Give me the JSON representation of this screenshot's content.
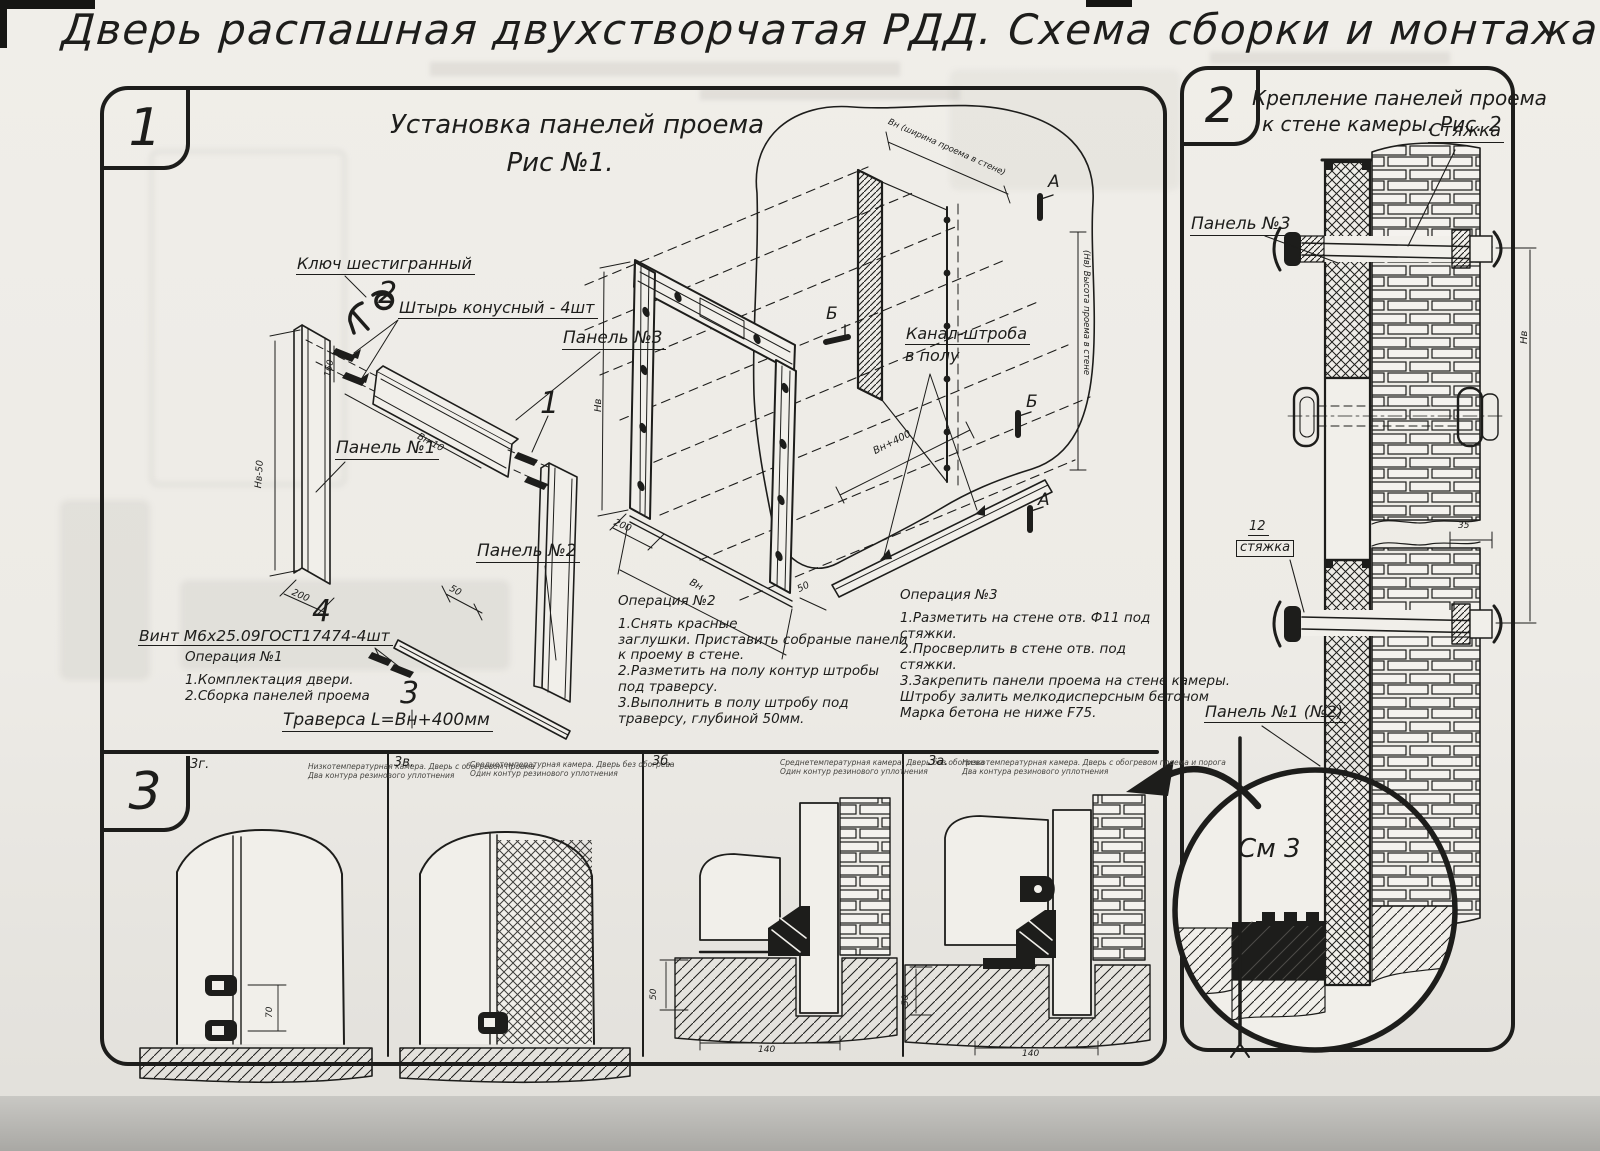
{
  "title": "Дверь распашная двухстворчатая РДД.  Схема сборки и монтажа №2",
  "s1": {
    "badge": "1",
    "fig_title": "Установка панелей проема",
    "fig_sub": "Рис №1.",
    "labels": {
      "hex_key": "Ключ шестигранный",
      "pin": "Штырь конусный - 4шт",
      "panel3": "Панель №3",
      "panel1": "Панель №1",
      "panel2": "Панель №2",
      "screw": "Винт М6х25.09ГОСТ17474-4шт",
      "traverse": "Траверса  L=Вн+400мм",
      "channel1": "Канал-штроба",
      "channel2": "в полу"
    },
    "callouts": {
      "c1": "1",
      "c2": "2",
      "c3": "3",
      "c4": "4"
    },
    "markers": {
      "a": "А",
      "b": "Б"
    },
    "dims": {
      "nv50": "Нв-50",
      "d200": "200",
      "d160": "160",
      "vn10": "Вн-10",
      "d50": "50",
      "nv": "Нв",
      "vn": "Вн",
      "vn400": "Вн+400",
      "top": "Вн (ширина проема в стене)",
      "right": "(Нв) Высота проема в стене"
    },
    "op1": {
      "title": "Операция №1",
      "lines": [
        "1.Комплектация двери.",
        "2.Сборка панелей проема"
      ]
    },
    "op2": {
      "title": "Операция №2",
      "lines": [
        "1.Снять красные",
        "заглушки. Приставить собраные панели",
        "к проему в стене.",
        "2.Разметить на полу контур штробы",
        "под траверсу.",
        "3.Выполнить в полу штробу под",
        "траверсу, глубиной 50мм."
      ]
    },
    "op3": {
      "title": "Операция №3",
      "lines": [
        "1.Разметить на стене отв. Ф11 под",
        "стяжки.",
        "2.Просверлить в стене отв.  под",
        "стяжки.",
        "3.Закрепить панели проема на стене камеры.",
        "Штробу залить мелкодисперсным бетоном",
        "Марка бетона не ниже   F75."
      ]
    }
  },
  "s2": {
    "badge": "2",
    "title1": "Крепление панелей проема",
    "title2": "к стене камеры. Рис. 2",
    "labels": {
      "tie": "Стяжка",
      "panel3": "Панель №3",
      "tie_num": "12",
      "tie_word": "стяжка",
      "panel12": "Панель №1 (№2)",
      "see": "См 3"
    },
    "dims": {
      "nv": "Нв",
      "d35": "35"
    }
  },
  "s3": {
    "badge": "3",
    "panels": [
      {
        "code": "3г.",
        "d1": "Низкотемпературная камера. Дверь с обогревом проема",
        "d2": "Два контура резинового уплотнения"
      },
      {
        "code": "3в.",
        "d1": "Среднетемпературная камера. Дверь без обогрева",
        "d2": "Один контур резинового уплотнения"
      },
      {
        "code": "3б.",
        "d1": "Среднетемпературная камера. Дверь без обогрева",
        "d2": "Один контур резинового уплотнения"
      },
      {
        "code": "3а.",
        "d1": "Низкотемпературная камера. Дверь с обогревом проема и порога",
        "d2": "Два контура резинового уплотнения"
      }
    ],
    "dims": {
      "d70": "70",
      "d50": "50",
      "d140": "140"
    }
  }
}
